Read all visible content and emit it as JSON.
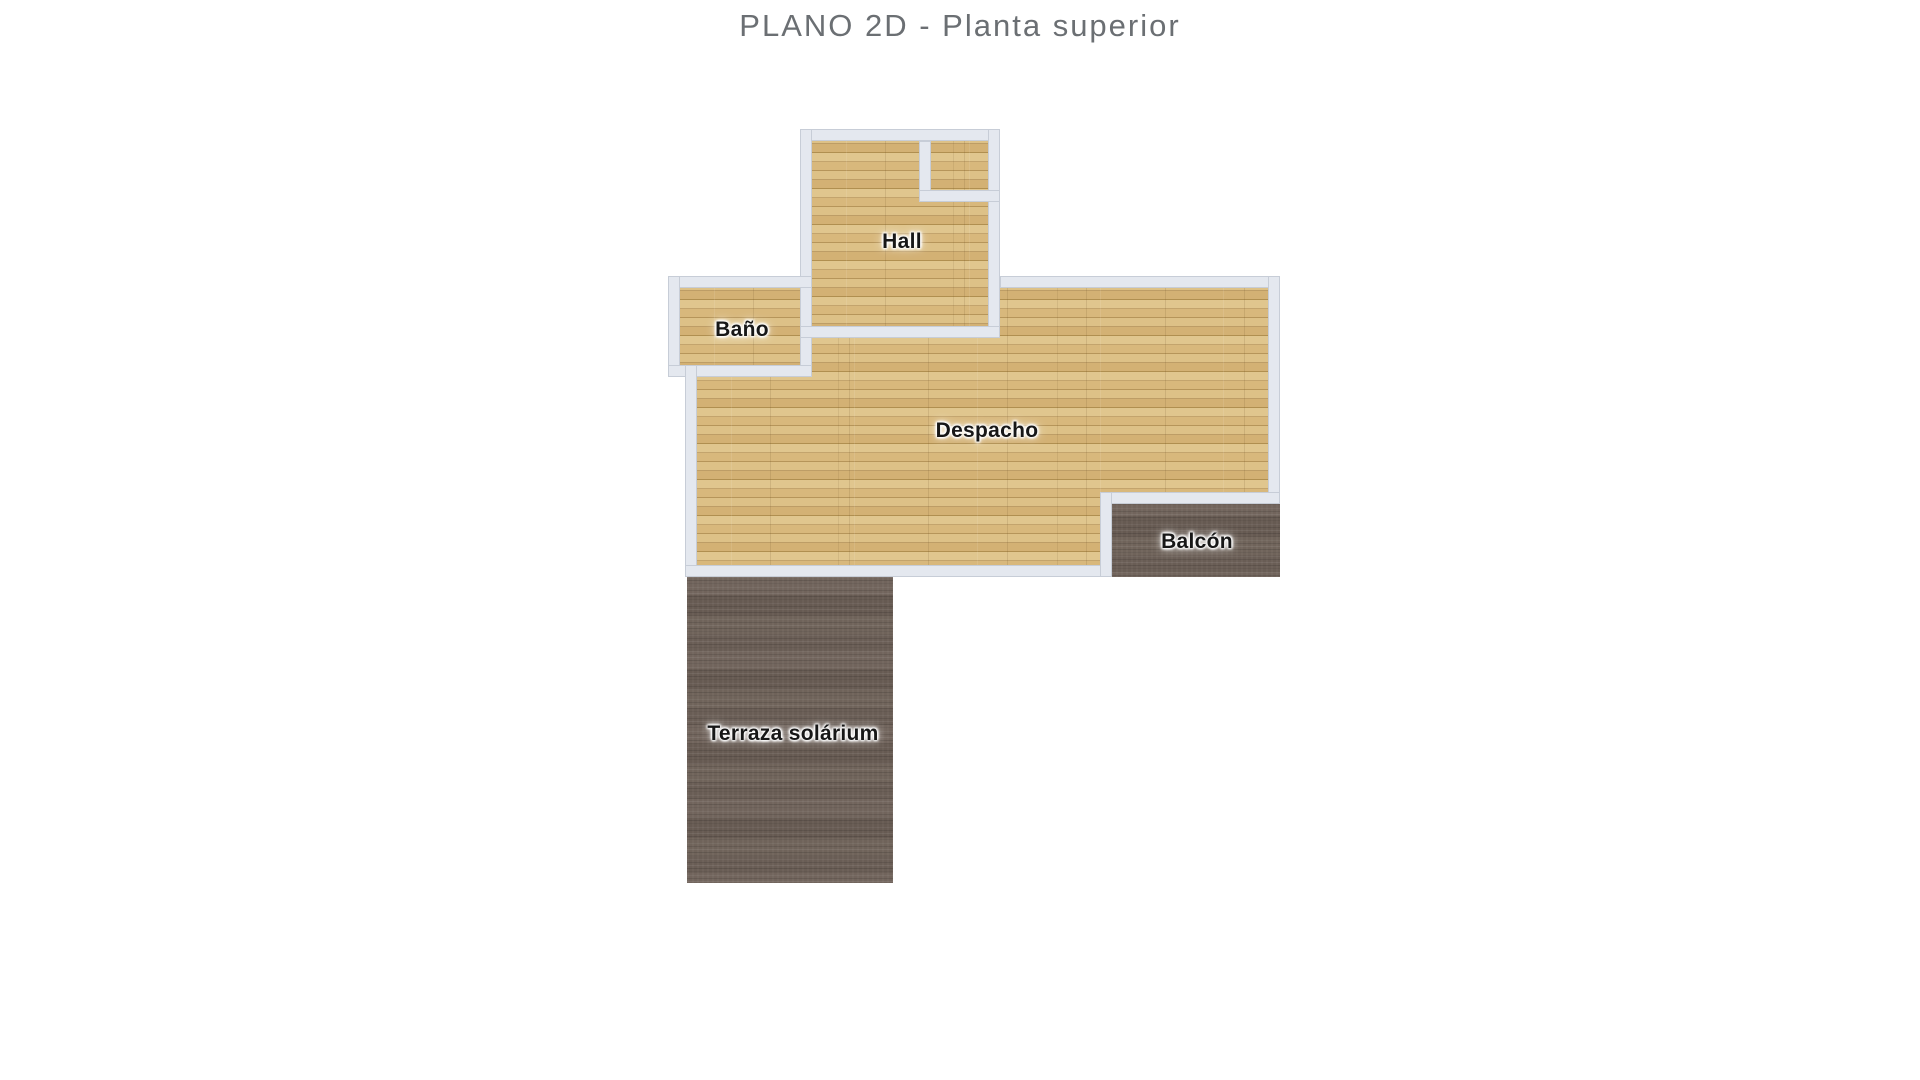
{
  "page": {
    "title": "PLANO 2D - Planta superior"
  },
  "plan": {
    "rooms": [
      {
        "name": "hall",
        "label": "Hall",
        "floor": "wood"
      },
      {
        "name": "bano",
        "label": "Baño",
        "floor": "wood"
      },
      {
        "name": "despacho",
        "label": "Despacho",
        "floor": "wood"
      },
      {
        "name": "balcon",
        "label": "Balcón",
        "floor": "dark"
      },
      {
        "name": "terraza",
        "label": "Terraza solárium",
        "floor": "dark"
      }
    ]
  },
  "palette": {
    "title-color": "#6b6f73",
    "wall-fill": "#e4e8ef",
    "wall-line": "#c7cdd7",
    "wood-base": "#d8b97e",
    "wood-light": "#e0c68e",
    "wood-dark": "#b08f50",
    "dark-floor": "#6d6058",
    "label-color": "#171717"
  }
}
